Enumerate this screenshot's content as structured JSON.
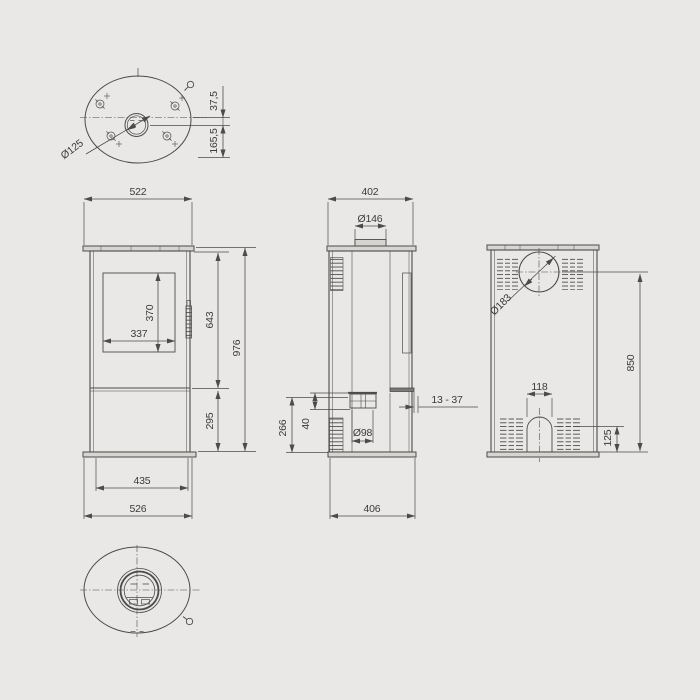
{
  "drawing": {
    "type": "technical-dimension-drawing",
    "subject": "oval wood stove, four orthographic views",
    "colors": {
      "background": "#e9e8e6",
      "line": "#4b4b49",
      "text": "#3b3b3b",
      "plate_fill": "#d6d5d2"
    },
    "dims": {
      "top_view": {
        "flue_offset": "37,5",
        "flue_to_front": "165,5",
        "flue_dia": "Ø125"
      },
      "front_view": {
        "top_width": "522",
        "glass_height": "370",
        "glass_width": "337",
        "upper_height": "643",
        "total_height": "976",
        "lower_height": "295",
        "door_width": "435",
        "base_width": "526"
      },
      "side_view": {
        "top_depth": "402",
        "flue_dia": "Ø146",
        "air_inlet_height": "266",
        "stub_offset": "40",
        "air_inlet_dia": "Ø98",
        "base_depth": "406",
        "wall_gap": "13 - 37"
      },
      "back_view": {
        "rear_flue_dia": "Ø183",
        "flue_center_height": "850",
        "arch_width": "118",
        "arch_height": "125"
      }
    }
  }
}
